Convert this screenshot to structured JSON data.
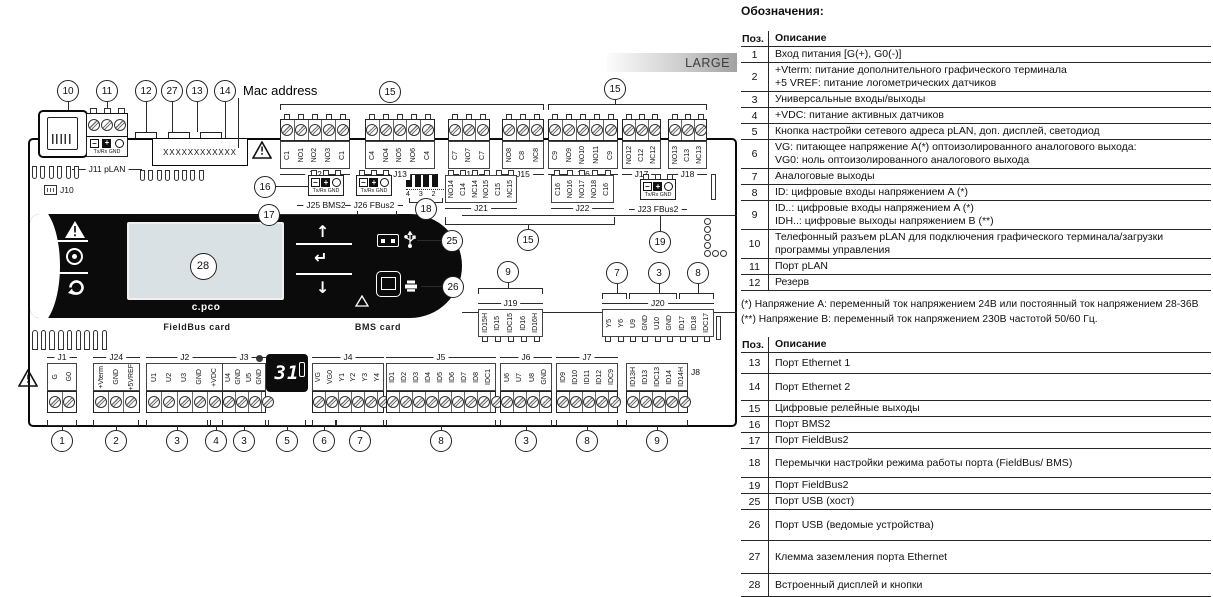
{
  "diagram": {
    "large_badge": "LARGE",
    "mac_address_label": "Mac address",
    "mac_value": "XXXXXXXXXXXX",
    "j10_label": "J10",
    "j11_label": "J11 pLAN",
    "comm_sub": "Tx/Rx GND",
    "logo": "c.pco",
    "fieldbus_card": "FieldBus card",
    "bms_card": "BMS card",
    "seven_seg": "31",
    "jumper_labels": "4 3 2 1",
    "j8_side_label": "J8",
    "comm_blocks": [
      {
        "name": "J25 BMS2",
        "x": 308,
        "y": 170
      },
      {
        "name": "J26 FBus2",
        "x": 356,
        "y": 170
      },
      {
        "name": "J23 FBus2",
        "x": 640,
        "y": 174
      }
    ],
    "blocks": [
      {
        "name": "J12",
        "type": "top",
        "x": 280,
        "y": 114,
        "pw": 14,
        "pins": [
          "C1",
          "NO1",
          "NO2",
          "NO3",
          "C1"
        ]
      },
      {
        "name": "J13",
        "type": "top",
        "x": 365,
        "y": 114,
        "pw": 14,
        "pins": [
          "C4",
          "NO4",
          "NO5",
          "NO6",
          "C4"
        ]
      },
      {
        "name": "J14",
        "type": "top",
        "x": 448,
        "y": 114,
        "pw": 14,
        "pins": [
          "C7",
          "NO7",
          "C7"
        ]
      },
      {
        "name": "J15",
        "type": "top",
        "x": 502,
        "y": 114,
        "pw": 14,
        "pins": [
          "NO8",
          "C8",
          "NC8"
        ]
      },
      {
        "name": "J16",
        "type": "top",
        "x": 548,
        "y": 114,
        "pw": 14,
        "pins": [
          "C9",
          "NO9",
          "NO10",
          "NO11",
          "C9"
        ]
      },
      {
        "name": "J17",
        "type": "top",
        "x": 622,
        "y": 114,
        "pw": 13,
        "pins": [
          "NO12",
          "C12",
          "NC12"
        ]
      },
      {
        "name": "J18",
        "type": "top",
        "x": 668,
        "y": 114,
        "pw": 13,
        "pins": [
          "NO13",
          "C13",
          "NC13"
        ]
      },
      {
        "name": "J21",
        "type": "toplite",
        "x": 445,
        "y": 170,
        "pw": 12,
        "pins": [
          "NO14",
          "C14",
          "NC14",
          "NO15",
          "C15",
          "NC15"
        ]
      },
      {
        "name": "J22",
        "type": "toplite",
        "x": 551,
        "y": 170,
        "pw": 12.6,
        "pins": [
          "C16",
          "NO16",
          "NO17",
          "NO18",
          "C16"
        ]
      },
      {
        "name": "J19",
        "type": "mid",
        "x": 478,
        "y": 298,
        "pw": 13,
        "pins": [
          "ID15H",
          "ID15",
          "IDC15",
          "ID16",
          "ID16H"
        ]
      },
      {
        "name": "J20",
        "type": "mid",
        "x": 602,
        "y": 298,
        "pw": 12.4,
        "pins": [
          "Y5",
          "Y6",
          "U9",
          "GND",
          "U10",
          "GND",
          "ID17",
          "ID18",
          "IDC17"
        ]
      },
      {
        "name": "J1",
        "type": "bottom",
        "x": 47,
        "y": 352,
        "pw": 15,
        "pins": [
          "G",
          "G0"
        ]
      },
      {
        "name": "J24",
        "type": "bottom",
        "x": 93,
        "y": 352,
        "pw": 15.5,
        "pins": [
          "+Vterm",
          "GND",
          "+5VREF"
        ]
      },
      {
        "name": "J2",
        "type": "bottom",
        "x": 146,
        "y": 352,
        "pw": 15.5,
        "pins": [
          "U1",
          "U2",
          "U3",
          "GND",
          "+VDC"
        ]
      },
      {
        "name": "J3",
        "type": "bottom",
        "x": 222,
        "y": 352,
        "pw": 11,
        "pins": [
          "U4",
          "GND",
          "U5",
          "GND"
        ]
      },
      {
        "name": "J4",
        "type": "bottom",
        "x": 312,
        "y": 352,
        "pw": 12,
        "pins": [
          "VG",
          "VG0",
          "Y1",
          "Y2",
          "Y3",
          "Y4"
        ]
      },
      {
        "name": "J5",
        "type": "bottom",
        "x": 386,
        "y": 352,
        "pw": 12.2,
        "pins": [
          "ID1",
          "ID2",
          "ID3",
          "ID4",
          "ID5",
          "ID6",
          "ID7",
          "ID8",
          "IDC1"
        ]
      },
      {
        "name": "J6",
        "type": "bottom",
        "x": 500,
        "y": 352,
        "pw": 13,
        "pins": [
          "U6",
          "U7",
          "U8",
          "GND"
        ]
      },
      {
        "name": "J7",
        "type": "bottom",
        "x": 556,
        "y": 352,
        "pw": 12.4,
        "pins": [
          "ID9",
          "ID10",
          "ID11",
          "ID12",
          "IDC9"
        ]
      },
      {
        "name": "J8",
        "type": "bottom",
        "x": 626,
        "y": 352,
        "pw": 12.4,
        "nameSide": "right",
        "pins": [
          "ID13H",
          "ID13",
          "IDC13",
          "ID14",
          "ID14H"
        ]
      }
    ],
    "callouts": [
      {
        "n": "10",
        "x": 68,
        "y": 91
      },
      {
        "n": "11",
        "x": 107,
        "y": 91
      },
      {
        "n": "12",
        "x": 146,
        "y": 91
      },
      {
        "n": "27",
        "x": 172,
        "y": 91
      },
      {
        "n": "13",
        "x": 197,
        "y": 91
      },
      {
        "n": "14",
        "x": 225,
        "y": 91
      },
      {
        "n": "15",
        "x": 390,
        "y": 92
      },
      {
        "n": "15",
        "x": 615,
        "y": 89
      },
      {
        "n": "16",
        "x": 265,
        "y": 187
      },
      {
        "n": "17",
        "x": 269,
        "y": 215
      },
      {
        "n": "18",
        "x": 426,
        "y": 209
      },
      {
        "n": "19",
        "x": 660,
        "y": 242
      },
      {
        "n": "25",
        "x": 452,
        "y": 241
      },
      {
        "n": "15",
        "x": 528,
        "y": 240
      },
      {
        "n": "9",
        "x": 508,
        "y": 272
      },
      {
        "n": "7",
        "x": 617,
        "y": 273
      },
      {
        "n": "3",
        "x": 659,
        "y": 273
      },
      {
        "n": "8",
        "x": 698,
        "y": 273
      },
      {
        "n": "26",
        "x": 453,
        "y": 287
      },
      {
        "n": "28",
        "x": 203,
        "y": 266,
        "s": 27
      },
      {
        "n": "1",
        "x": 62,
        "y": 441
      },
      {
        "n": "2",
        "x": 116,
        "y": 441
      },
      {
        "n": "3",
        "x": 177,
        "y": 441
      },
      {
        "n": "4",
        "x": 216,
        "y": 441
      },
      {
        "n": "3",
        "x": 244,
        "y": 441
      },
      {
        "n": "5",
        "x": 287,
        "y": 441
      },
      {
        "n": "6",
        "x": 324,
        "y": 441
      },
      {
        "n": "7",
        "x": 360,
        "y": 441
      },
      {
        "n": "8",
        "x": 441,
        "y": 441
      },
      {
        "n": "3",
        "x": 526,
        "y": 441
      },
      {
        "n": "8",
        "x": 587,
        "y": 441
      },
      {
        "n": "9",
        "x": 657,
        "y": 441
      }
    ],
    "lines": [
      [
        68,
        102,
        "v",
        8
      ],
      [
        107,
        102,
        "v",
        6
      ],
      [
        146,
        102,
        "v",
        30
      ],
      [
        172,
        102,
        "v",
        30
      ],
      [
        197,
        102,
        "v",
        30
      ],
      [
        225,
        102,
        "v",
        36
      ],
      [
        238,
        98,
        "v",
        50
      ],
      [
        615,
        100,
        "v",
        4
      ],
      [
        660,
        213,
        "v",
        18
      ],
      [
        528,
        225,
        "v",
        4
      ],
      [
        508,
        283,
        "v",
        5
      ],
      [
        617,
        284,
        "v",
        9
      ],
      [
        659,
        284,
        "v",
        9
      ],
      [
        698,
        284,
        "v",
        9
      ],
      [
        445,
        217,
        "v",
        7
      ],
      [
        614,
        217,
        "v",
        7
      ],
      [
        445,
        224,
        "h",
        170
      ],
      [
        276,
        186,
        "h",
        32
      ],
      [
        280,
        214,
        "h",
        97
      ],
      [
        417,
        240,
        "h",
        24
      ],
      [
        421,
        286,
        "h",
        21
      ],
      [
        462,
        215,
        "h",
        275
      ],
      [
        462,
        312,
        "h",
        275
      ],
      [
        62,
        426,
        "v",
        4
      ],
      [
        116,
        426,
        "v",
        4
      ],
      [
        177,
        426,
        "v",
        4
      ],
      [
        216,
        426,
        "v",
        4
      ],
      [
        244,
        426,
        "v",
        4
      ],
      [
        287,
        426,
        "v",
        4
      ],
      [
        324,
        426,
        "v",
        4
      ],
      [
        360,
        426,
        "v",
        4
      ],
      [
        441,
        426,
        "v",
        4
      ],
      [
        526,
        426,
        "v",
        4
      ],
      [
        587,
        426,
        "v",
        4
      ],
      [
        657,
        426,
        "v",
        4
      ]
    ],
    "brackets": [
      [
        280,
        104,
        264,
        6,
        "down"
      ],
      [
        548,
        104,
        159,
        6,
        "down"
      ],
      [
        478,
        288,
        65,
        6,
        "down"
      ],
      [
        602,
        293,
        25,
        6,
        "down"
      ],
      [
        629,
        293,
        48,
        6,
        "down"
      ],
      [
        679,
        293,
        35,
        6,
        "down"
      ],
      [
        641,
        208,
        38,
        5,
        "up"
      ],
      [
        409,
        198,
        34,
        5,
        "up"
      ],
      [
        357,
        211,
        40,
        4,
        "up"
      ],
      [
        47,
        420,
        30,
        6,
        "up"
      ],
      [
        93,
        420,
        46,
        6,
        "up"
      ],
      [
        146,
        420,
        62,
        6,
        "up"
      ],
      [
        210,
        420,
        13,
        6,
        "up"
      ],
      [
        222,
        420,
        44,
        6,
        "up"
      ],
      [
        268,
        420,
        38,
        6,
        "up"
      ],
      [
        312,
        420,
        24,
        6,
        "up"
      ],
      [
        336,
        420,
        48,
        6,
        "up"
      ],
      [
        386,
        420,
        110,
        6,
        "up"
      ],
      [
        500,
        420,
        52,
        6,
        "up"
      ],
      [
        556,
        420,
        62,
        6,
        "up"
      ],
      [
        626,
        420,
        62,
        6,
        "up"
      ]
    ],
    "vents": [
      {
        "x": 32,
        "y": 166,
        "n": 6,
        "w": 5,
        "gap": 3.4,
        "h": 13,
        "round": "bottom"
      },
      {
        "x": 140,
        "y": 170,
        "n": 8,
        "w": 5,
        "gap": 3.4,
        "h": 11,
        "round": "bottom"
      },
      {
        "x": 32,
        "y": 330,
        "n": 9,
        "w": 5.5,
        "gap": 3.2,
        "h": 20,
        "round": "top"
      }
    ],
    "leds": [
      [
        704,
        218
      ],
      [
        704,
        226
      ],
      [
        704,
        234
      ],
      [
        704,
        242
      ],
      [
        704,
        250
      ],
      [
        712,
        250
      ],
      [
        720,
        250
      ]
    ],
    "side_slots": [
      [
        711,
        174,
        5,
        26
      ],
      [
        716,
        316,
        5,
        24
      ]
    ],
    "tabs": [
      [
        135,
        132,
        22
      ],
      [
        168,
        132,
        22
      ],
      [
        200,
        132,
        22
      ]
    ]
  },
  "legend": {
    "title": "Обозначения:",
    "pos_header": "Поз.",
    "desc_header": "Описание",
    "table1": [
      {
        "pos": "1",
        "h": 14,
        "desc": [
          "Вход питания [G(+), G0(-)]"
        ]
      },
      {
        "pos": "2",
        "h": 27,
        "desc": [
          "+Vterm: питание дополнительного графического терминала",
          "+5 VREF: питание логометрических датчиков"
        ]
      },
      {
        "pos": "3",
        "h": 14,
        "desc": [
          "Универсальные входы/выходы"
        ]
      },
      {
        "pos": "4",
        "h": 14,
        "desc": [
          "+VDC: питание активных датчиков"
        ]
      },
      {
        "pos": "5",
        "h": 14,
        "desc": [
          "Кнопка настройки сетевого адреса pLAN, доп. дисплей, светодиод"
        ]
      },
      {
        "pos": "6",
        "h": 27,
        "desc": [
          "VG: питающее напряжение A(*) оптоизолированного аналогового выхода:",
          "VG0: ноль оптоизолированного аналогового выхода"
        ]
      },
      {
        "pos": "7",
        "h": 13,
        "desc": [
          "Аналоговые выходы"
        ]
      },
      {
        "pos": "8",
        "h": 14,
        "desc": [
          "ID: цифровые входы напряжением A (*)"
        ]
      },
      {
        "pos": "9",
        "h": 27,
        "desc": [
          "ID..: цифровые входы напряжением A (*)",
          "IDH..: цифровые выходы напряжением B (**)"
        ]
      },
      {
        "pos": "10",
        "h": 27,
        "desc": [
          "Телефонный разъем pLAN для подключения графического терминала/загрузки",
          "программы управления"
        ]
      },
      {
        "pos": "11",
        "h": 14,
        "desc": [
          "Порт pLAN"
        ]
      },
      {
        "pos": "12",
        "h": 14,
        "desc": [
          "Резерв"
        ]
      }
    ],
    "footnotes": [
      "(*) Напряжение A: переменный ток напряжением 24В или постоянный ток напряжением 28-36В",
      "(**) Напряжение B: переменный ток напряжением 230В частотой 50/60 Гц."
    ],
    "table2": [
      {
        "pos": "13",
        "h": 20,
        "desc": [
          "Порт Ethernet 1"
        ]
      },
      {
        "pos": "14",
        "h": 26,
        "desc": [
          "Порт Ethernet 2"
        ]
      },
      {
        "pos": "15",
        "h": 15,
        "desc": [
          "Цифровые релейные выходы"
        ]
      },
      {
        "pos": "16",
        "h": 14,
        "desc": [
          "Порт BMS2"
        ]
      },
      {
        "pos": "17",
        "h": 14,
        "desc": [
          "Порт FieldBus2"
        ]
      },
      {
        "pos": "18",
        "h": 28,
        "desc": [
          "Перемычки настройки режима работы порта (FieldBus/ BMS)"
        ]
      },
      {
        "pos": "19",
        "h": 15,
        "desc": [
          "Порт FieldBus2"
        ]
      },
      {
        "pos": "25",
        "h": 15,
        "desc": [
          "Порт USB (хост)"
        ]
      },
      {
        "pos": "26",
        "h": 30,
        "desc": [
          "Порт USB (ведомые устройства)"
        ]
      },
      {
        "pos": "27",
        "h": 32,
        "desc": [
          "Клемма заземления порта Ethernet"
        ]
      },
      {
        "pos": "28",
        "h": 22,
        "desc": [
          "Встроенный дисплей и кнопки"
        ]
      }
    ]
  }
}
